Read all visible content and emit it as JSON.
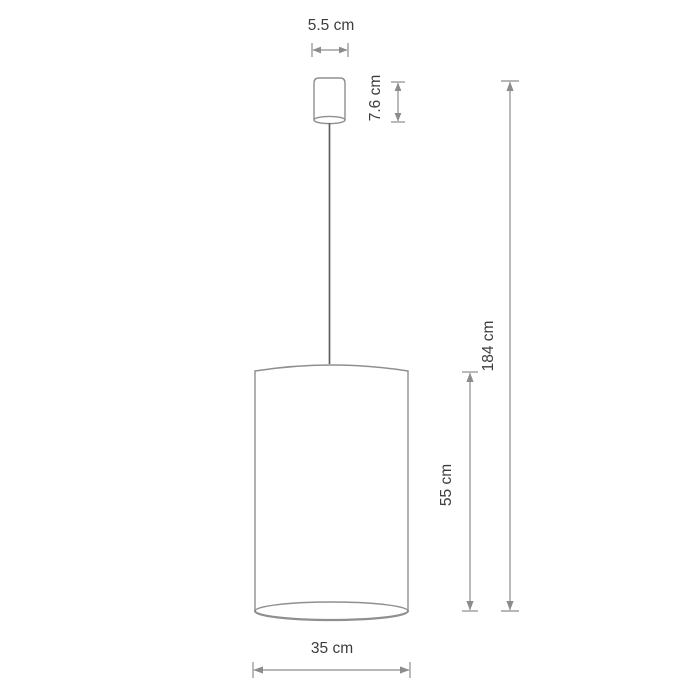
{
  "diagram": {
    "labels": {
      "canopy_width": "5.5 cm",
      "canopy_height": "7.6 cm",
      "overall_height": "184 cm",
      "shade_height": "55 cm",
      "shade_diameter": "35 cm"
    },
    "colors": {
      "background": "#ffffff",
      "outline": "#8f8f8f",
      "dimension": "#8c8c8c",
      "cord": "#5f5f5f",
      "text": "#3d3d3d"
    }
  }
}
